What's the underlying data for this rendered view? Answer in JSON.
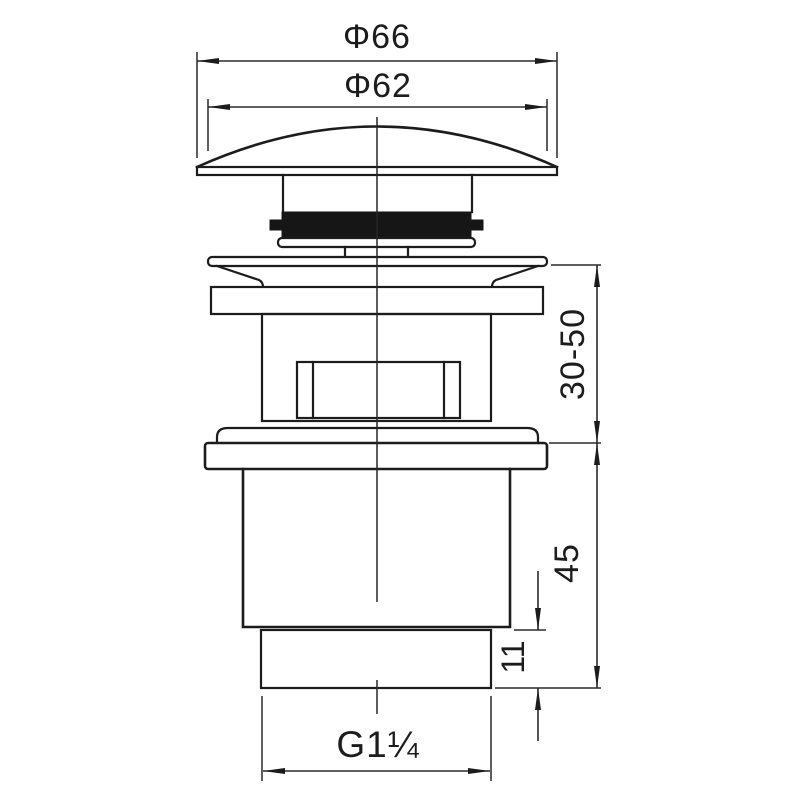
{
  "drawing": {
    "type": "technical-dimension-drawing",
    "subject": "basin pop-up waste drain side view",
    "colors": {
      "line": "#1c1c1c",
      "dimension_line": "#2a2a2a",
      "background": "#ffffff",
      "gasket_fill": "#161616"
    },
    "dimensions": {
      "cap_outer_diameter": "Φ66",
      "cap_top_diameter": "Φ62",
      "mounting_range": "30-50",
      "body_height": "45",
      "tail_thread_length": "11",
      "thread_size": "G1¼"
    }
  }
}
